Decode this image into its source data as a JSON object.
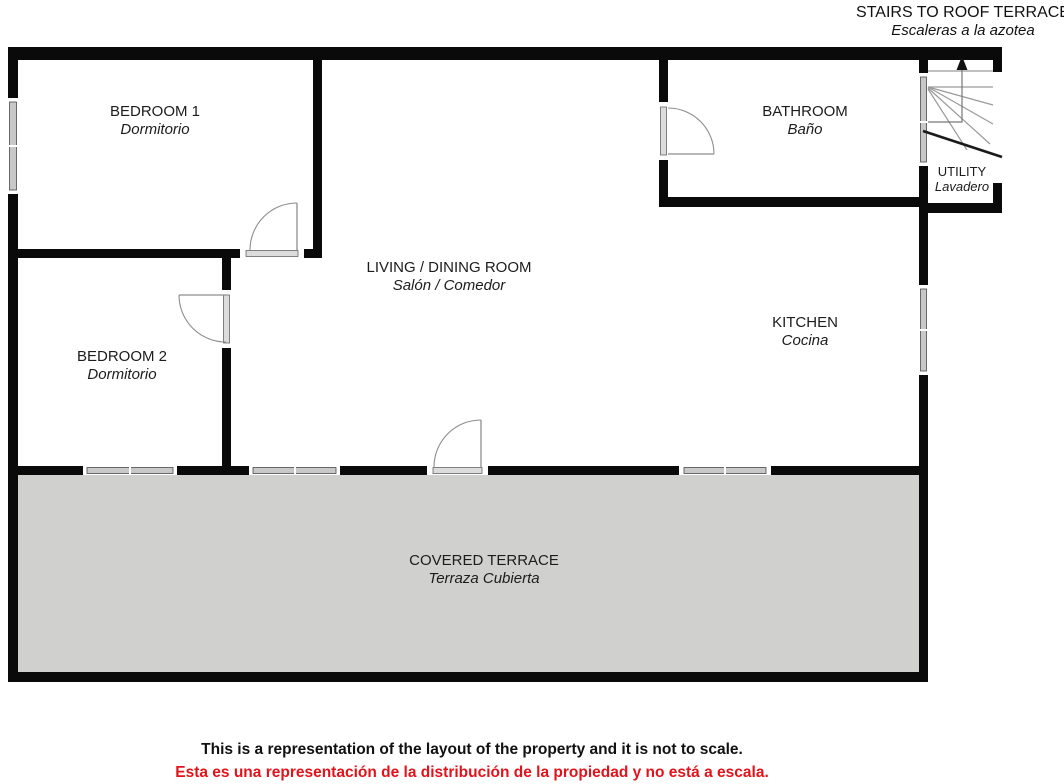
{
  "header": {
    "line1": "STAIRS TO ROOF TERRACE",
    "line2": "Escaleras a la azotea"
  },
  "rooms": [
    {
      "name_en": "BEDROOM 1",
      "name_es": "Dormitorio"
    },
    {
      "name_en": "BATHROOM",
      "name_es": "Baño"
    },
    {
      "name_en": "UTILITY",
      "name_es": "Lavadero"
    },
    {
      "name_en": "LIVING / DINING ROOM",
      "name_es": "Salón / Comedor"
    },
    {
      "name_en": "KITCHEN",
      "name_es": "Cocina"
    },
    {
      "name_en": "BEDROOM 2",
      "name_es": "Dormitorio"
    },
    {
      "name_en": "COVERED TERRACE",
      "name_es": "Terraza Cubierta"
    }
  ],
  "disclaimer": {
    "en": "This is a representation of the layout of the property and it is not to scale.",
    "es": "Esta es una representación de la distribución de la propiedad y no está a escala."
  },
  "icons": {
    "stairs_up_arrow": "upward arrow marking stair direction to roof terrace"
  },
  "colors": {
    "wall": "#0a0a0a",
    "terrace_fill": "#d0d0ce",
    "window_fill": "#c8c8c8",
    "threshold_fill": "#dcdcdc",
    "stair_line": "#9a9a9a",
    "label": "#1c1c1c",
    "red_text": "#e2131a"
  }
}
